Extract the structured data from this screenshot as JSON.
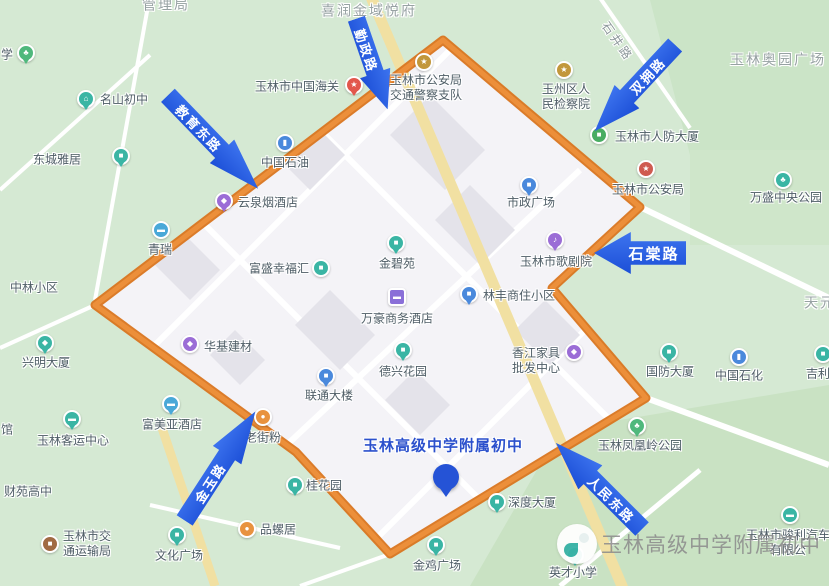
{
  "district": {
    "name": "玉林高级中学附属初中",
    "boundary_points": "443,40 640,207 552,288 646,398 390,554 296,452 95,305",
    "boundary_color": "#e0812f",
    "label": {
      "x": 443,
      "y": 445,
      "color": "#2b50cc"
    },
    "pin": {
      "x": 446,
      "y": 477
    }
  },
  "watermark": {
    "logo_icon": "school-bird-logo",
    "text": "玉林高级中学附属初中",
    "logo_x": 578,
    "logo_y": 545,
    "text_x": 600,
    "text_y": 546
  },
  "colors": {
    "map_green": "#d5e9d3",
    "urban_area": "#f4f3f7",
    "boundary_orange": "#e0812f",
    "arrow_blue": "#2055db",
    "district_title_blue": "#2b50cc",
    "poi_label_gray": "#4e5d66"
  },
  "road_arrows": [
    {
      "label": "教育东路",
      "x": 213,
      "y": 142,
      "w": 130,
      "h": 34,
      "rotate": 46,
      "dir": "right",
      "fs": 13
    },
    {
      "label": "勤政路",
      "x": 372,
      "y": 64,
      "w": 96,
      "h": 32,
      "rotate": 71,
      "dir": "right",
      "fs": 13
    },
    {
      "label": "双拥路",
      "x": 635,
      "y": 88,
      "w": 118,
      "h": 34,
      "rotate": -47,
      "dir": "left",
      "fs": 13
    },
    {
      "label": "石棠路",
      "x": 640,
      "y": 253,
      "w": 92,
      "h": 42,
      "rotate": 0,
      "dir": "left",
      "fs": 15
    },
    {
      "label": "金玉路",
      "x": 220,
      "y": 466,
      "w": 130,
      "h": 34,
      "rotate": -57,
      "dir": "right",
      "fs": 13
    },
    {
      "label": "人民东路",
      "x": 599,
      "y": 486,
      "w": 122,
      "h": 34,
      "rotate": 45,
      "dir": "left",
      "fs": 13
    }
  ],
  "pois": [
    {
      "t": "管理局",
      "x": 166,
      "y": 5,
      "cls": "area"
    },
    {
      "t": "喜润金域悦府",
      "x": 369,
      "y": 11,
      "cls": "area"
    },
    {
      "t": "玉林奥园广场",
      "x": 778,
      "y": 60,
      "cls": "area"
    },
    {
      "t": "天元",
      "x": 820,
      "y": 303,
      "cls": "area"
    },
    {
      "t": "石井路",
      "x": 617,
      "y": 42,
      "cls": "roadname",
      "rot": 55
    },
    {
      "t": "学",
      "x": 7,
      "y": 55,
      "icon": {
        "n": "tree-pin-icon",
        "c": "#4fb87c",
        "s": "pin",
        "x": 26,
        "y": 53
      }
    },
    {
      "t": "名山初中",
      "x": 124,
      "y": 100,
      "icon": {
        "n": "school-pin-icon",
        "c": "#3ab5a4",
        "s": "pin",
        "x": 86,
        "y": 99
      }
    },
    {
      "t": "东城雅居",
      "x": 57,
      "y": 160,
      "icon": {
        "n": "building-pin-icon",
        "c": "#3ab5a4",
        "s": "pin",
        "x": 121,
        "y": 156
      }
    },
    {
      "t": "玉林市中国海关",
      "x": 297,
      "y": 87,
      "icon": {
        "n": "star-pin-icon",
        "c": "#e2574c",
        "s": "pin",
        "x": 354,
        "y": 85
      }
    },
    {
      "lines": [
        "玉林市公安局",
        "交通警察支队"
      ],
      "x": 426,
      "y": 88,
      "icon": {
        "n": "police-badge-icon",
        "c": "#c2973b",
        "s": "dot",
        "x": 424,
        "y": 62
      }
    },
    {
      "lines": [
        "玉州区人",
        "民检察院"
      ],
      "x": 566,
      "y": 97,
      "icon": {
        "n": "gov-badge-icon",
        "c": "#c2973b",
        "s": "dot",
        "x": 564,
        "y": 70
      }
    },
    {
      "t": "玉林市人防大厦",
      "x": 657,
      "y": 137,
      "icon": {
        "n": "building-dot-icon",
        "c": "#49ad62",
        "s": "dot",
        "x": 599,
        "y": 135
      }
    },
    {
      "t": "玉林市公安局",
      "x": 648,
      "y": 190,
      "icon": {
        "n": "police-badge-icon",
        "c": "#cf5b50",
        "s": "dot",
        "x": 646,
        "y": 169
      }
    },
    {
      "t": "万盛中央公园",
      "x": 786,
      "y": 198,
      "icon": {
        "n": "park-dot-icon",
        "c": "#3ab5a4",
        "s": "dot",
        "x": 783,
        "y": 180
      }
    },
    {
      "t": "市政广场",
      "x": 531,
      "y": 203,
      "icon": {
        "n": "building-pin-icon",
        "c": "#4a89dc",
        "s": "pin",
        "x": 529,
        "y": 185
      }
    },
    {
      "t": "玉林市歌剧院",
      "x": 556,
      "y": 262,
      "icon": {
        "n": "theater-pin-icon",
        "c": "#9b6dd6",
        "s": "pin",
        "x": 555,
        "y": 240
      }
    },
    {
      "t": "中国石油",
      "x": 285,
      "y": 163,
      "icon": {
        "n": "fuel-dot-icon",
        "c": "#4a89dc",
        "s": "dot",
        "x": 285,
        "y": 143
      }
    },
    {
      "t": "云泉烟酒店",
      "x": 268,
      "y": 203,
      "icon": {
        "n": "shop-bag-pin-icon",
        "c": "#9b6dd6",
        "s": "pin",
        "x": 224,
        "y": 201
      }
    },
    {
      "t": "青瑞",
      "x": 160,
      "y": 250,
      "icon": {
        "n": "car-dot-icon",
        "c": "#49a8d8",
        "s": "dot",
        "x": 161,
        "y": 230
      }
    },
    {
      "t": "富盛幸福汇",
      "x": 279,
      "y": 269,
      "icon": {
        "n": "building-dot-icon",
        "c": "#3ab5a4",
        "s": "dot",
        "x": 321,
        "y": 268
      }
    },
    {
      "t": "金碧苑",
      "x": 397,
      "y": 264,
      "icon": {
        "n": "building-pin-icon",
        "c": "#3ab5a4",
        "s": "pin",
        "x": 396,
        "y": 243
      }
    },
    {
      "t": "万豪商务酒店",
      "x": 397,
      "y": 319,
      "icon": {
        "n": "hotel-bed-icon",
        "c": "#8a6fd8",
        "s": "square",
        "x": 397,
        "y": 297
      }
    },
    {
      "t": "林丰商住小区",
      "x": 519,
      "y": 296,
      "icon": {
        "n": "building-pin-icon",
        "c": "#4a89dc",
        "s": "pin",
        "x": 469,
        "y": 294
      }
    },
    {
      "t": "德兴花园",
      "x": 403,
      "y": 372,
      "icon": {
        "n": "building-pin-icon",
        "c": "#3ab5a4",
        "s": "pin",
        "x": 403,
        "y": 350
      }
    },
    {
      "lines": [
        "香江家具",
        "批发中心"
      ],
      "x": 536,
      "y": 361,
      "icon": {
        "n": "shop-bag-dot-icon",
        "c": "#9b6dd6",
        "s": "dot",
        "x": 574,
        "y": 352
      }
    },
    {
      "t": "国防大厦",
      "x": 670,
      "y": 372,
      "icon": {
        "n": "building-pin-icon",
        "c": "#3ab5a4",
        "s": "pin",
        "x": 669,
        "y": 352
      }
    },
    {
      "t": "中国石化",
      "x": 739,
      "y": 376,
      "icon": {
        "n": "fuel-dot-icon",
        "c": "#4a89dc",
        "s": "dot",
        "x": 739,
        "y": 357
      }
    },
    {
      "t": "吉利",
      "x": 818,
      "y": 374,
      "icon": {
        "n": "building-dot-icon",
        "c": "#3ab5a4",
        "s": "dot",
        "x": 823,
        "y": 354
      }
    },
    {
      "t": "中林小区",
      "x": 34,
      "y": 288
    },
    {
      "t": "兴明大厦",
      "x": 46,
      "y": 363,
      "icon": {
        "n": "briefcase-pin-icon",
        "c": "#3ab5a4",
        "s": "pin",
        "x": 45,
        "y": 343
      }
    },
    {
      "t": "华基建材",
      "x": 228,
      "y": 347,
      "icon": {
        "n": "shop-bag-dot-icon",
        "c": "#9b6dd6",
        "s": "dot",
        "x": 190,
        "y": 344
      }
    },
    {
      "t": "联通大楼",
      "x": 329,
      "y": 396,
      "icon": {
        "n": "building-pin-icon",
        "c": "#4a89dc",
        "s": "pin",
        "x": 326,
        "y": 376
      }
    },
    {
      "t": "老街粉",
      "x": 263,
      "y": 438,
      "icon": {
        "n": "food-dot-icon",
        "c": "#e8923f",
        "s": "dot",
        "x": 263,
        "y": 417
      }
    },
    {
      "t": "玉林客运中心",
      "x": 73,
      "y": 441,
      "icon": {
        "n": "bus-pin-icon",
        "c": "#3ab5a4",
        "s": "pin",
        "x": 72,
        "y": 419
      }
    },
    {
      "t": "富美亚酒店",
      "x": 172,
      "y": 425,
      "icon": {
        "n": "hotel-bed-pin-icon",
        "c": "#49a8d8",
        "s": "pin",
        "x": 171,
        "y": 404
      }
    },
    {
      "t": "馆",
      "x": 7,
      "y": 430
    },
    {
      "t": "财苑高中",
      "x": 28,
      "y": 492
    },
    {
      "lines": [
        "玉林市交",
        "通运输局"
      ],
      "x": 87,
      "y": 544,
      "icon": {
        "n": "gov-dot-icon",
        "c": "#a06a43",
        "s": "dot",
        "x": 50,
        "y": 544
      }
    },
    {
      "t": "文化广场",
      "x": 179,
      "y": 556,
      "icon": {
        "n": "building-pin-icon",
        "c": "#3ab5a4",
        "s": "pin",
        "x": 177,
        "y": 535
      }
    },
    {
      "t": "品螺居",
      "x": 278,
      "y": 530,
      "icon": {
        "n": "food-dot-icon",
        "c": "#e8923f",
        "s": "dot",
        "x": 247,
        "y": 529
      }
    },
    {
      "t": "桂花园",
      "x": 324,
      "y": 486,
      "icon": {
        "n": "building-pin-icon",
        "c": "#3ab5a4",
        "s": "pin",
        "x": 295,
        "y": 485
      }
    },
    {
      "t": "金鸡广场",
      "x": 437,
      "y": 566,
      "icon": {
        "n": "building-pin-icon",
        "c": "#3ab5a4",
        "s": "pin",
        "x": 436,
        "y": 545
      }
    },
    {
      "t": "深度大厦",
      "x": 532,
      "y": 503,
      "icon": {
        "n": "building-pin-icon",
        "c": "#3ab5a4",
        "s": "pin",
        "x": 497,
        "y": 502
      }
    },
    {
      "t": "玉林凤凰岭公园",
      "x": 640,
      "y": 446,
      "icon": {
        "n": "tree-pin-icon",
        "c": "#4fb87c",
        "s": "pin",
        "x": 637,
        "y": 426
      }
    },
    {
      "lines": [
        "玉林市骏利汽车",
        "有限公"
      ],
      "x": 788,
      "y": 543,
      "icon": {
        "n": "car-dot-icon",
        "c": "#3ab5a4",
        "s": "dot",
        "x": 790,
        "y": 515
      }
    },
    {
      "t": "英才小学",
      "x": 573,
      "y": 573,
      "icon": {
        "n": "school-pin-icon",
        "c": "#3ab5a4",
        "s": "pin",
        "x": 575,
        "y": 555
      }
    }
  ]
}
